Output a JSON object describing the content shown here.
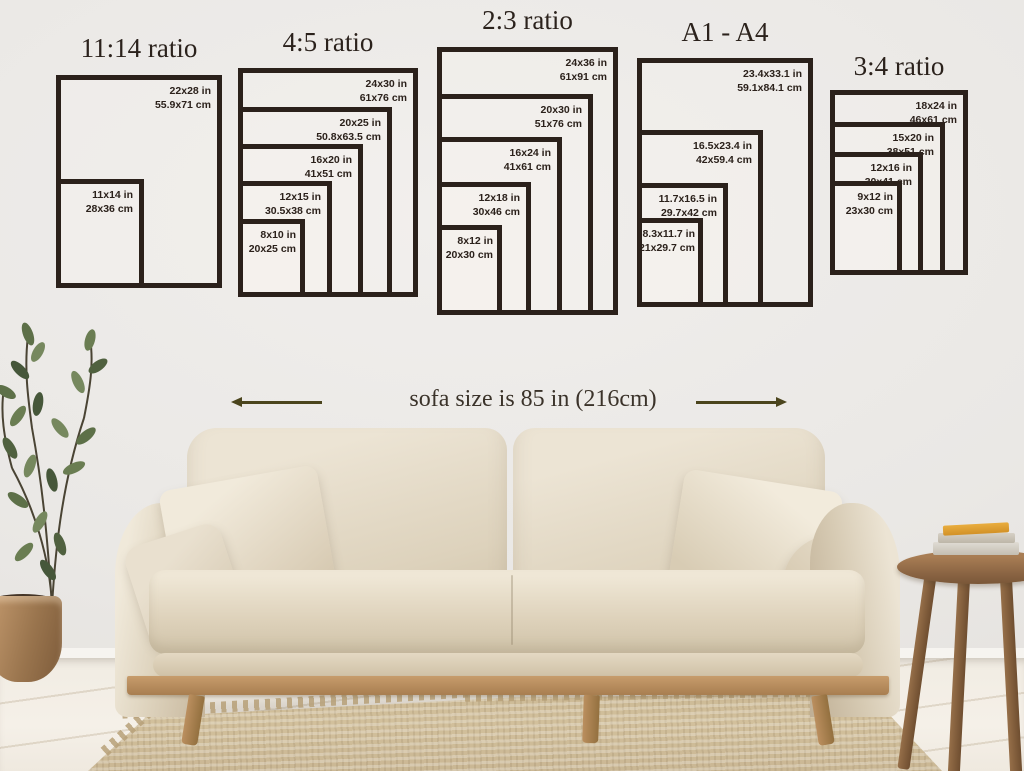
{
  "ratio_groups": [
    {
      "title": "11:14 ratio",
      "frames": [
        {
          "inches": "22x28 in",
          "cm": "55.9x71 cm"
        },
        {
          "inches": "11x14 in",
          "cm": "28x36 cm"
        }
      ]
    },
    {
      "title": "4:5 ratio",
      "frames": [
        {
          "inches": "24x30 in",
          "cm": "61x76 cm"
        },
        {
          "inches": "20x25 in",
          "cm": "50.8x63.5 cm"
        },
        {
          "inches": "16x20 in",
          "cm": "41x51 cm"
        },
        {
          "inches": "12x15 in",
          "cm": "30.5x38 cm"
        },
        {
          "inches": "8x10 in",
          "cm": "20x25 cm"
        }
      ]
    },
    {
      "title": "2:3 ratio",
      "frames": [
        {
          "inches": "24x36 in",
          "cm": "61x91 cm"
        },
        {
          "inches": "20x30 in",
          "cm": "51x76 cm"
        },
        {
          "inches": "16x24 in",
          "cm": "41x61 cm"
        },
        {
          "inches": "12x18 in",
          "cm": "30x46 cm"
        },
        {
          "inches": "8x12 in",
          "cm": "20x30 cm"
        }
      ]
    },
    {
      "title": "A1 - A4",
      "frames": [
        {
          "inches": "23.4x33.1 in",
          "cm": "59.1x84.1 cm"
        },
        {
          "inches": "16.5x23.4 in",
          "cm": "42x59.4 cm"
        },
        {
          "inches": "11.7x16.5 in",
          "cm": "29.7x42 cm"
        },
        {
          "inches": "8.3x11.7 in",
          "cm": "21x29.7 cm"
        }
      ]
    },
    {
      "title": "3:4 ratio",
      "frames": [
        {
          "inches": "18x24 in",
          "cm": "46x61 cm"
        },
        {
          "inches": "15x20 in",
          "cm": "38x51 cm"
        },
        {
          "inches": "12x16 in",
          "cm": "30x41 cm"
        },
        {
          "inches": "9x12 in",
          "cm": "23x30 cm"
        }
      ]
    }
  ],
  "annotation": {
    "sofa_caption": "sofa size is 85 in (216cm)"
  },
  "colors": {
    "frame_border": "#2b211b",
    "title_text": "#2b221c",
    "label_text": "#2b211b",
    "arrow": "#4b451d",
    "caption_text": "#3b332a"
  }
}
